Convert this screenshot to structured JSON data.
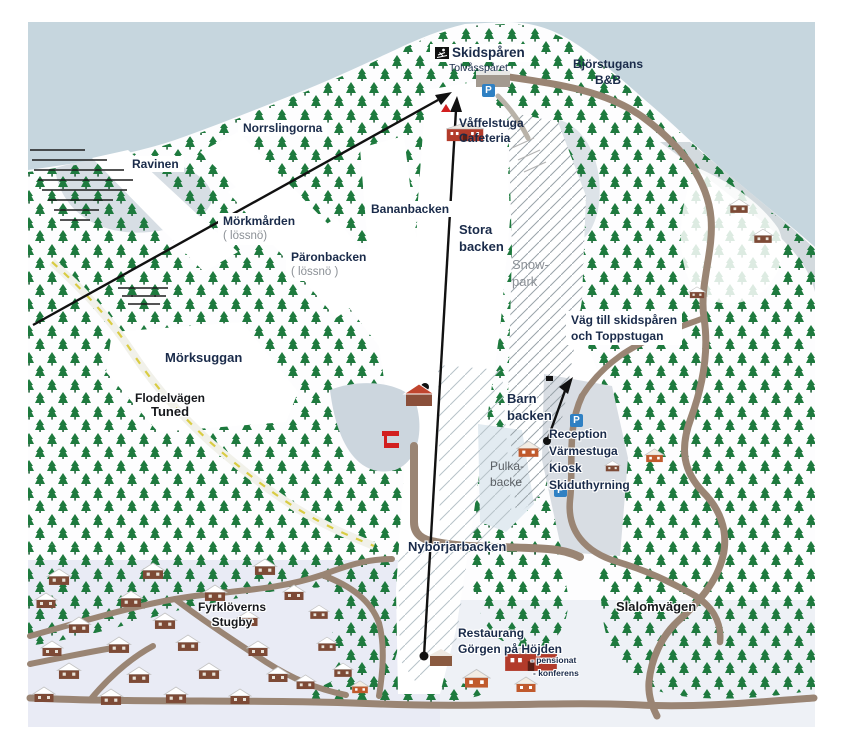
{
  "map_type": "ski-resort-panorama-map",
  "labels": {
    "skidsparen": "Skidspåren",
    "tolvasparet": "Tolvåsspåret",
    "bjorstugans_1": "Björstugans",
    "bjorstugans_2": "B&B",
    "vaffelstuga_1": "Våffelstuga",
    "vaffelstuga_2": "Cafeteria",
    "norrslingorna": "Norrslingorna",
    "ravinen": "Ravinen",
    "morkmarden_1": "Mörkmården",
    "morkmarden_2": "( lössnö)",
    "paronbacken_1": "Päronbacken",
    "paronbacken_2": "( lössnö )",
    "bananbacken": "Bananbacken",
    "stora_1": "Stora",
    "stora_2": "backen",
    "snowpark_1": "Snow-",
    "snowpark_2": "park",
    "vag_1": "Väg till skidspåren",
    "vag_2": "och Toppstugan",
    "morksuggan": "Mörksuggan",
    "flodelvagen_1": "Flodelvägen",
    "flodelvagen_2": "Tuned",
    "barn_1": "Barn",
    "barn_2": "backen",
    "pulka_1": "Pulka-",
    "pulka_2": "backe",
    "reception_1": "Reception",
    "reception_2": "Värmestuga",
    "reception_3": "Kiosk",
    "reception_4": "Skiduthyrning",
    "nyborjarbacken": "Nybörjarbacken",
    "fyrkloverns_1": "Fyrklöverns",
    "fyrkloverns_2": "Stugby",
    "restaurang_1": "Restaurang",
    "restaurang_2": "Görgen på Höjden",
    "slalomvagen": "Slalomvägen",
    "pensionat": "- pensionat",
    "konferens": "- konferens",
    "parking": "P"
  },
  "icons": {
    "skier": "skier-pictogram",
    "parking": "P-square-blue",
    "red_flag": "red-flag-marker",
    "red_triangle": "red-roof-marker"
  },
  "colors": {
    "sky": "#c6d6de",
    "forest_green": "#1e7a3e",
    "road_brown": "#9a8574",
    "road_yellow_dash": "#d9cc43",
    "label_navy": "#1a2b4a",
    "gray_text": "#8b9096",
    "parking_blue": "#2f80c3",
    "building_red": "#b23b2a",
    "cabin_brown": "#7d4a36",
    "village_snow": "#e9ebf5"
  }
}
